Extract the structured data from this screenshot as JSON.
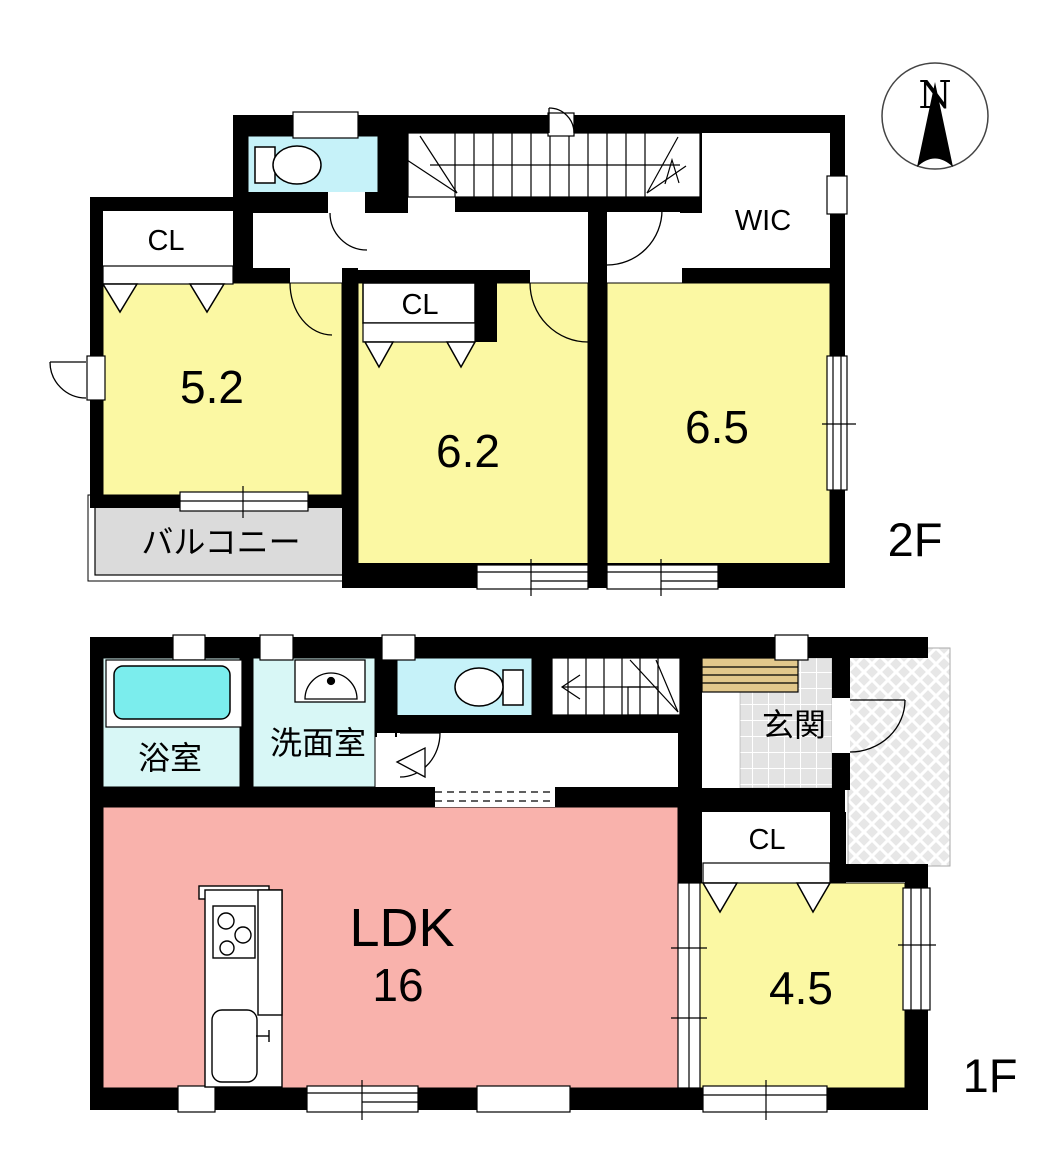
{
  "compass": {
    "north": "N"
  },
  "floor_2f": {
    "label": "2F",
    "closet_left_label": "CL",
    "closet_62_label": "CL",
    "wic_label": "WIC",
    "room_52": "5.2",
    "room_62": "6.2",
    "room_65": "6.5",
    "balcony_label": "バルコニー"
  },
  "floor_1f": {
    "label": "1F",
    "bath_label": "浴室",
    "washroom_label": "洗面室",
    "entrance_label": "玄関",
    "closet_label": "CL",
    "ldk_label": "LDK",
    "ldk_size": "16",
    "room_45": "4.5"
  },
  "colors": {
    "wall": "#000000",
    "room_yellow": "#FBF8A3",
    "ldk_pink": "#F9B2AC",
    "toilet_cyan": "#C6F2F9",
    "wet_floor_cyan": "#D8F7F6",
    "bathtub_cyan": "#7BEDED",
    "balcony_gray": "#DBDBDB",
    "tile_gray": "#E3E3E3",
    "porch_gray": "#E7E7E7",
    "wood_tan": "#E2C88C"
  }
}
